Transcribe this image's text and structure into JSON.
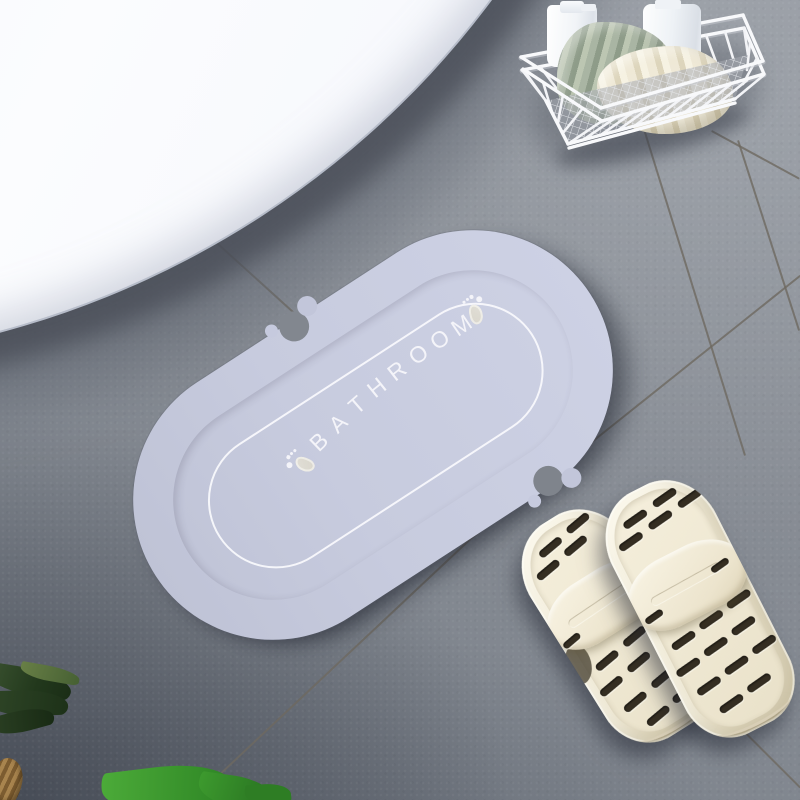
{
  "mat": {
    "text": "BATHROOM",
    "letters": [
      "B",
      "A",
      "T",
      "H",
      "R",
      "O",
      "O",
      "M"
    ]
  },
  "colors": {
    "floor": "#868b93",
    "grout": "#6e6960",
    "tub": "#f2f4fa",
    "mat-outer": "#c7cbde",
    "mat-outer2": "#cdd1e4",
    "mat-inner-a": "#8a8798",
    "mat-inner-b": "#a5a2b3",
    "mat-line": "#f4f4f9",
    "slipper": "#f3edda",
    "slot": "#352e22",
    "basket-wire": "#f8f9fb",
    "towel-green": "#9fac9b",
    "towel-cream": "#ece6d2",
    "bottle": "#fbfcfe",
    "leaf-dark": "#24391f",
    "leaf-bright": "#3f9e2e"
  }
}
